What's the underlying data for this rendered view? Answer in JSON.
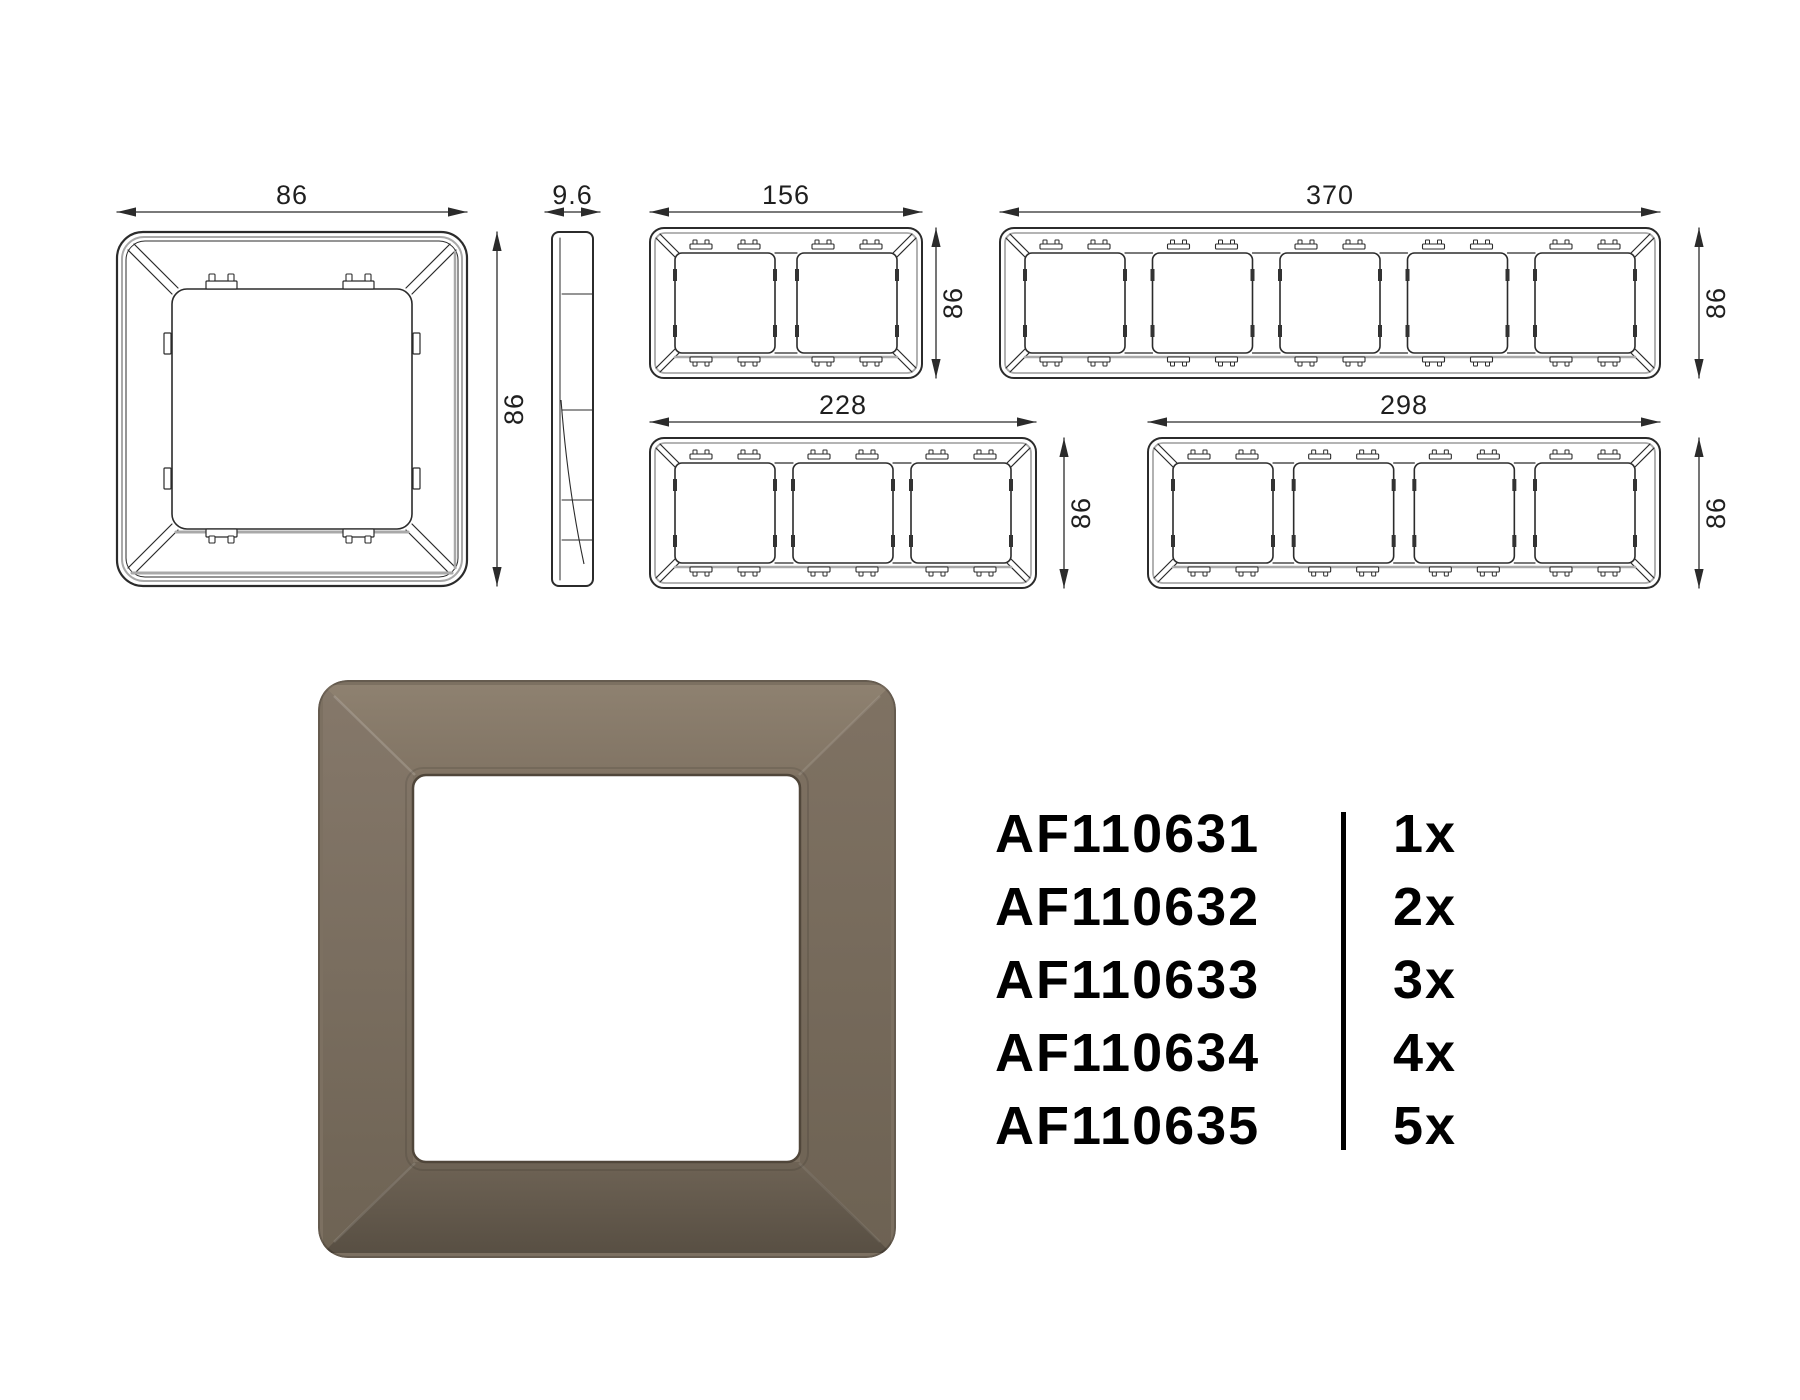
{
  "page": {
    "background": "#ffffff"
  },
  "drawing_style": {
    "line_color": "#2b2b2b",
    "shadow_color": "#a9a9a9",
    "dim_text_color": "#1f1f1f"
  },
  "technical_drawings": {
    "front_view": {
      "width_label": "86",
      "height_label": "86"
    },
    "side_view": {
      "thickness_label": "9.6"
    },
    "multi_frames": [
      {
        "gangs": 2,
        "width_label": "156",
        "height_label": "86"
      },
      {
        "gangs": 5,
        "width_label": "370",
        "height_label": "86"
      },
      {
        "gangs": 3,
        "width_label": "228",
        "height_label": "86"
      },
      {
        "gangs": 4,
        "width_label": "298",
        "height_label": "86"
      }
    ]
  },
  "product_photo": {
    "base_color": "#7c7061",
    "top_face_color": "#8c7f6e",
    "bottom_face_color": "#5c5347",
    "window_color": "#ffffff"
  },
  "product_list": {
    "items": [
      {
        "code": "AF110631",
        "qty": "1x"
      },
      {
        "code": "AF110632",
        "qty": "2x"
      },
      {
        "code": "AF110633",
        "qty": "3x"
      },
      {
        "code": "AF110634",
        "qty": "4x"
      },
      {
        "code": "AF110635",
        "qty": "5x"
      }
    ]
  }
}
